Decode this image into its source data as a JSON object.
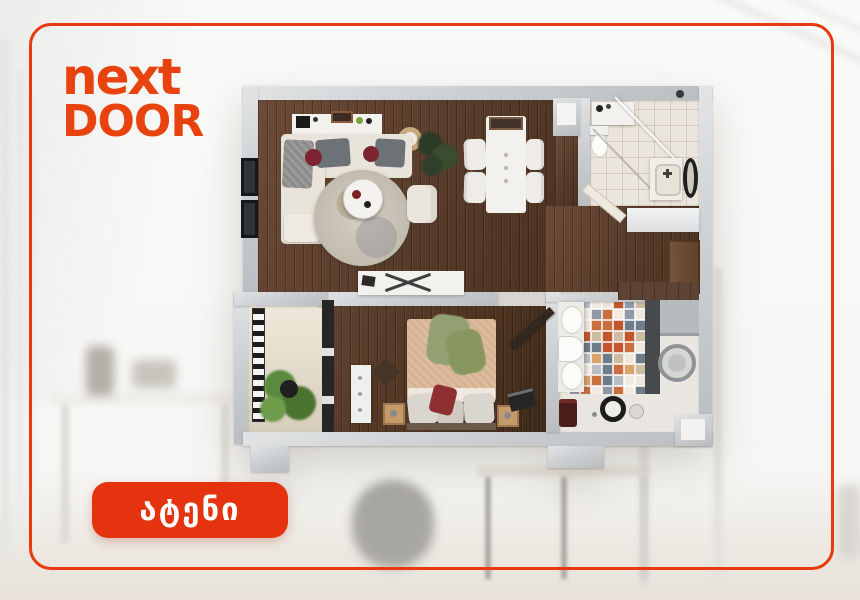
{
  "brand": {
    "name_line1": "next",
    "name_line2": "DOOR",
    "color": "#E8430F"
  },
  "badge": {
    "label": "ატენი",
    "background": "#E5330F",
    "text_color": "#FFFFFF"
  },
  "card": {
    "border_color": "#E8390F",
    "background": "#FFFFFF"
  },
  "floorplan": {
    "wall_color": "#C7CACC",
    "wood_floor_color": "#5B3E2C",
    "bathroom_tile_color": "#EAE5DD",
    "balcony_floor_color": "#E6DFD2",
    "accent_pillow_color": "#8E3032",
    "bed_blanket_color": "#D6B291",
    "kitchen_tile_palette": [
      "#C96F3F",
      "#B9BEC4",
      "#EDE7DD",
      "#8F9AA6",
      "#D9A36A",
      "#6E7B88",
      "#F1EBE1",
      "#C2572F",
      "#CDBBA4"
    ]
  }
}
